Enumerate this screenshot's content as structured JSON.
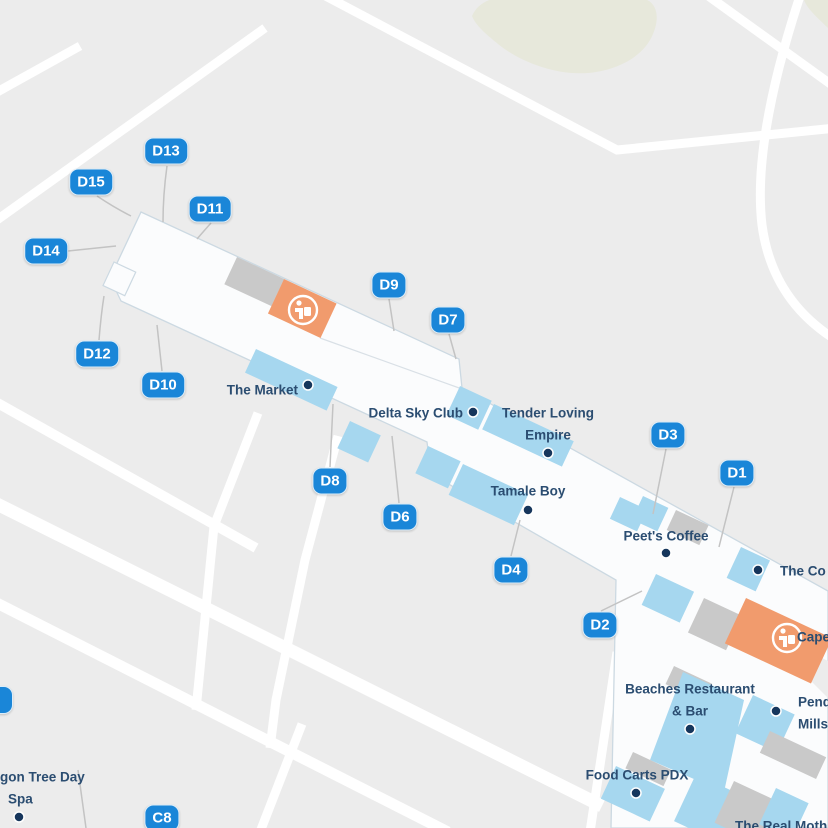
{
  "map": {
    "type": "airport-terminal-map",
    "gates": {
      "d13": "D13",
      "d15": "D15",
      "d11": "D11",
      "d14": "D14",
      "d12": "D12",
      "d10": "D10",
      "d9": "D9",
      "d7": "D7",
      "d8": "D8",
      "d6": "D6",
      "d4": "D4",
      "d2": "D2",
      "d3": "D3",
      "d1": "D1",
      "c8": "C8"
    },
    "pois": {
      "market": "The Market",
      "delta": "Delta Sky Club",
      "tle_line1": "Tender Loving",
      "tle_line2": "Empire",
      "tamale": "Tamale Boy",
      "peets": "Peet's Coffee",
      "theco": "The Co",
      "cape": "Cape",
      "beaches_line1": "Beaches Restaurant",
      "beaches_line2": "& Bar",
      "pend_line1": "Pend",
      "pend_line2": "Mills",
      "foodcarts": "Food Carts PDX",
      "dragon_line1": "gon Tree Day",
      "dragon_line2": "Spa",
      "realmoth": "The Real Moth"
    },
    "icons": {
      "restroom": "person-glyph-in-orange-circle"
    },
    "colors": {
      "background": "#ececec",
      "road": "#ffffff",
      "terminal_fill": "#fbfcfd",
      "terminal_stroke": "#ccd9e2",
      "shop_blue": "#a6d7ef",
      "block_gray": "#c9c9c9",
      "amenity_orange": "#f19b6d",
      "gate_pin_blue": "#1a86d8",
      "poi_text_navy": "#2b4d71",
      "poi_dot_navy": "#16365c",
      "leader_gray": "#c3c3c3",
      "grass_beige": "#e7e8db"
    }
  }
}
